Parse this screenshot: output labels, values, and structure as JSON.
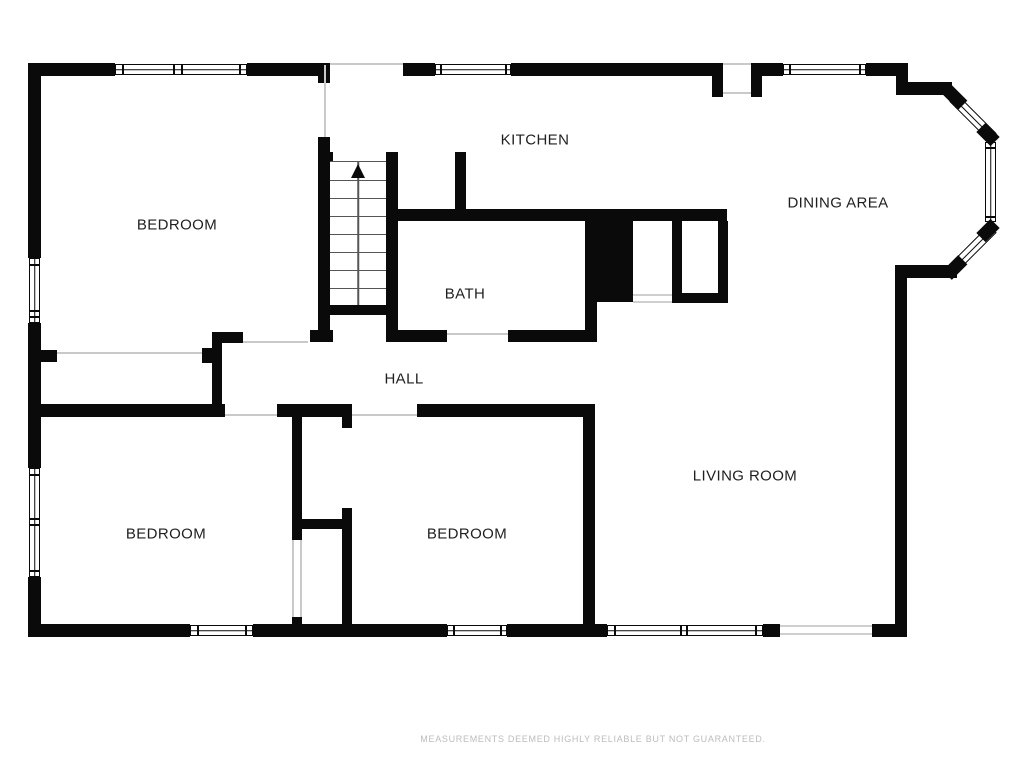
{
  "colors": {
    "wall": "#0a0a0a",
    "opening_line": "#c9c9c9",
    "stair_line": "#565656",
    "label_text": "#1f1f1f",
    "muted_text": "#bcbcbc",
    "background": "#ffffff"
  },
  "labels": [
    {
      "id": "bedroom-1",
      "text": "BEDROOM",
      "x": 177,
      "y": 225
    },
    {
      "id": "kitchen",
      "text": "KITCHEN",
      "x": 535,
      "y": 140
    },
    {
      "id": "dining-area",
      "text": "DINING AREA",
      "x": 838,
      "y": 203
    },
    {
      "id": "bath",
      "text": "BATH",
      "x": 465,
      "y": 294
    },
    {
      "id": "hall",
      "text": "HALL",
      "x": 404,
      "y": 379
    },
    {
      "id": "bedroom-2",
      "text": "BEDROOM",
      "x": 166,
      "y": 534
    },
    {
      "id": "bedroom-3",
      "text": "BEDROOM",
      "x": 467,
      "y": 534
    },
    {
      "id": "living-room",
      "text": "LIVING ROOM",
      "x": 745,
      "y": 476
    }
  ],
  "disclaimer": {
    "text": "MEASUREMENTS DEEMED HIGHLY RELIABLE BUT NOT GUARANTEED."
  },
  "plan": {
    "walls": [
      [
        28,
        63,
        87,
        13
      ],
      [
        247,
        63,
        83,
        13
      ],
      [
        403,
        63,
        32,
        13
      ],
      [
        511,
        63,
        201,
        13
      ],
      [
        762,
        63,
        21,
        13
      ],
      [
        866,
        63,
        42,
        13
      ],
      [
        712,
        63,
        11,
        34
      ],
      [
        751,
        63,
        11,
        34
      ],
      [
        896,
        63,
        12,
        32
      ],
      [
        908,
        82,
        44,
        13
      ],
      [
        895,
        265,
        62,
        13
      ],
      [
        895,
        278,
        12,
        359
      ],
      [
        28,
        624,
        162,
        13
      ],
      [
        253,
        624,
        194,
        13
      ],
      [
        507,
        624,
        100,
        13
      ],
      [
        763,
        624,
        17,
        13
      ],
      [
        872,
        624,
        35,
        13
      ],
      [
        28,
        63,
        13,
        195
      ],
      [
        28,
        323,
        13,
        145
      ],
      [
        28,
        577,
        13,
        60
      ],
      [
        40,
        350,
        17,
        12
      ],
      [
        318,
        137,
        12,
        205
      ],
      [
        318,
        152,
        15,
        10
      ],
      [
        386,
        152,
        12,
        190
      ],
      [
        318,
        305,
        80,
        10
      ],
      [
        310,
        330,
        23,
        12
      ],
      [
        386,
        330,
        61,
        12
      ],
      [
        508,
        330,
        85,
        12
      ],
      [
        318,
        76,
        12,
        7
      ],
      [
        455,
        152,
        11,
        60
      ],
      [
        398,
        209,
        329,
        12
      ],
      [
        585,
        221,
        12,
        121
      ],
      [
        585,
        209,
        48,
        93
      ],
      [
        672,
        221,
        10,
        82
      ],
      [
        718,
        221,
        10,
        82
      ],
      [
        672,
        293,
        56,
        10
      ],
      [
        40,
        404,
        185,
        13
      ],
      [
        277,
        404,
        75,
        13
      ],
      [
        417,
        404,
        178,
        13
      ],
      [
        212,
        332,
        31,
        11
      ],
      [
        212,
        343,
        10,
        61
      ],
      [
        202,
        348,
        10,
        15
      ],
      [
        292,
        417,
        10,
        123
      ],
      [
        292,
        617,
        10,
        8
      ],
      [
        294,
        519,
        56,
        10
      ],
      [
        342,
        417,
        10,
        11
      ],
      [
        342,
        508,
        10,
        117
      ],
      [
        583,
        417,
        12,
        208
      ]
    ],
    "gray_lines": [
      [
        330,
        63,
        73,
        2
      ],
      [
        324,
        65,
        2,
        72
      ],
      [
        723,
        63,
        28,
        2
      ],
      [
        723,
        92,
        28,
        2
      ],
      [
        447,
        333,
        61,
        2
      ],
      [
        243,
        341,
        65,
        2
      ],
      [
        57,
        352,
        145,
        2
      ],
      [
        225,
        414,
        52,
        2
      ],
      [
        352,
        414,
        65,
        2
      ],
      [
        292,
        540,
        2,
        77
      ],
      [
        300,
        540,
        2,
        77
      ]
    ],
    "openings": [
      [
        780,
        625,
        92,
        10
      ],
      [
        633,
        294,
        39,
        9
      ]
    ],
    "windows": [
      {
        "x": 115,
        "y": 64,
        "w": 132,
        "h": 11,
        "o": "h",
        "div": [
          7,
          58,
          66,
          124
        ]
      },
      {
        "x": 435,
        "y": 64,
        "w": 76,
        "h": 11,
        "o": "h",
        "div": [
          5,
          70
        ]
      },
      {
        "x": 783,
        "y": 64,
        "w": 83,
        "h": 11,
        "o": "h",
        "div": [
          6,
          76
        ]
      },
      {
        "x": 190,
        "y": 625,
        "w": 63,
        "h": 11,
        "o": "h",
        "div": [
          7,
          55
        ]
      },
      {
        "x": 447,
        "y": 625,
        "w": 60,
        "h": 11,
        "o": "h",
        "div": [
          6,
          53
        ]
      },
      {
        "x": 607,
        "y": 625,
        "w": 156,
        "h": 11,
        "o": "h",
        "div": [
          7,
          73,
          79,
          148
        ]
      },
      {
        "x": 29,
        "y": 258,
        "w": 11,
        "h": 65,
        "o": "v",
        "div": [
          6,
          52,
          58
        ]
      },
      {
        "x": 29,
        "y": 468,
        "w": 11,
        "h": 109,
        "o": "v",
        "div": [
          6,
          50,
          56,
          102
        ]
      },
      {
        "x": 985,
        "y": 142,
        "w": 11,
        "h": 80,
        "o": "v",
        "div": [
          5,
          74
        ]
      }
    ],
    "diag_windows": [
      {
        "cx": 973,
        "cy": 117,
        "len": 56,
        "t": 11,
        "a": 45
      },
      {
        "cx": 973,
        "cy": 248,
        "len": 56,
        "t": 11,
        "a": -45
      }
    ],
    "diag_blocks": [
      {
        "cx": 955,
        "cy": 97,
        "w": 22,
        "h": 13,
        "a": 45
      },
      {
        "cx": 988,
        "cy": 134,
        "w": 20,
        "h": 13,
        "a": 45
      },
      {
        "cx": 988,
        "cy": 230,
        "w": 20,
        "h": 13,
        "a": -45
      },
      {
        "cx": 955,
        "cy": 267,
        "w": 22,
        "h": 13,
        "a": -45
      }
    ],
    "stairs": {
      "x": 330,
      "y": 161,
      "w": 56,
      "h": 144,
      "steps": 8
    }
  }
}
